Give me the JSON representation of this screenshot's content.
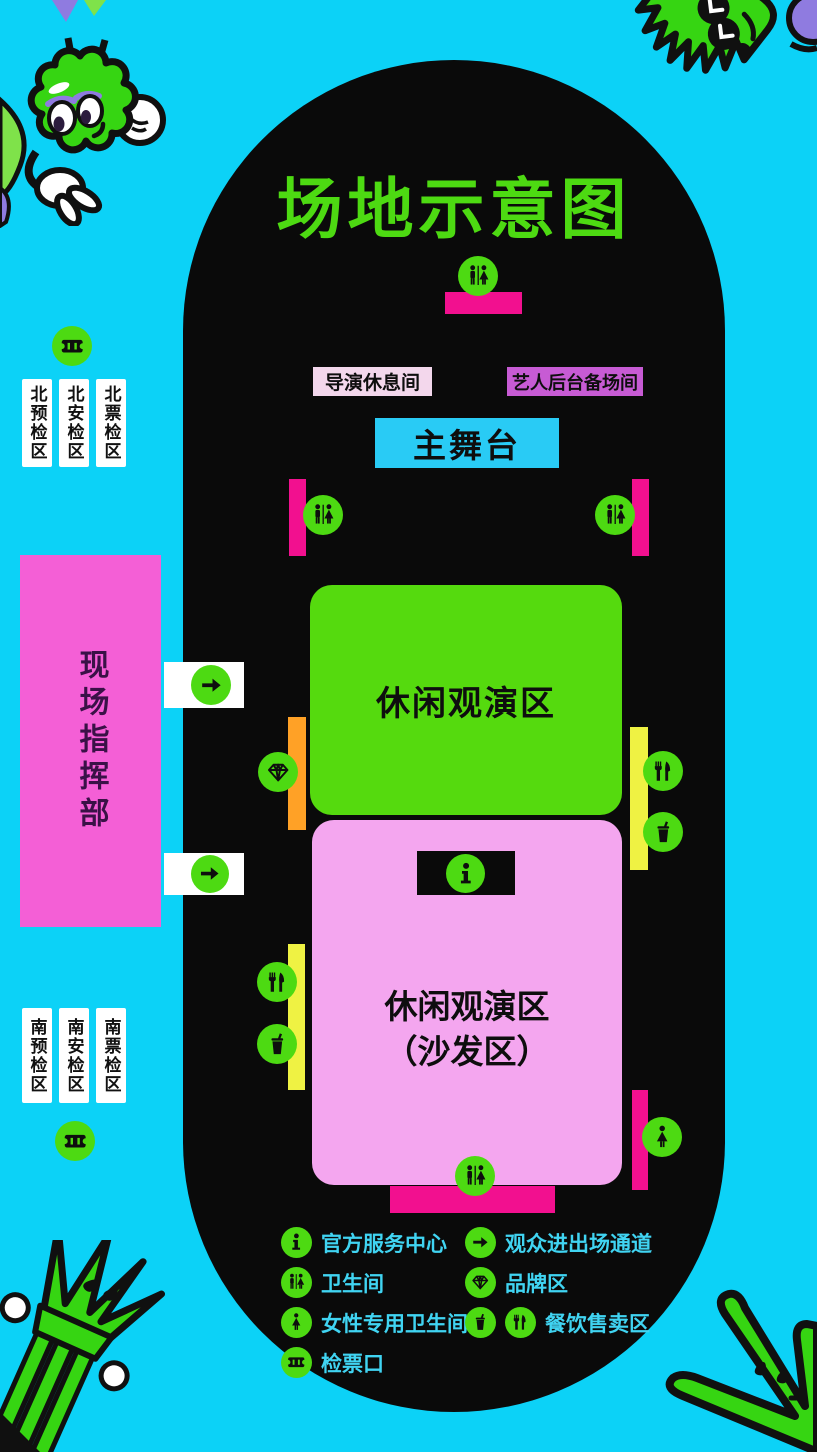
{
  "title": "场地示意图",
  "stage_area": {
    "director_lounge": "导演休息间",
    "artist_backstage": "艺人后台备场间",
    "main_stage": "主舞台"
  },
  "zones": {
    "leisure_viewing": "休闲观演区",
    "sofa_line1": "休闲观演区",
    "sofa_line2": "（沙发区）",
    "command_center": "现场指挥部"
  },
  "checkpoints": {
    "north": [
      "北预检区",
      "北安检区",
      "北票检区"
    ],
    "south": [
      "南预检区",
      "南安检区",
      "南票检区"
    ]
  },
  "legend": {
    "left": [
      {
        "icon": "info-icon",
        "label": "官方服务中心"
      },
      {
        "icon": "restroom-icon",
        "label": "卫生间"
      },
      {
        "icon": "female-restroom-icon",
        "label": "女性专用卫生间"
      },
      {
        "icon": "ticket-icon",
        "label": "检票口"
      }
    ],
    "right": [
      {
        "icon": "arrow-icon",
        "label": "观众进出场通道"
      },
      {
        "icon": "diamond-icon",
        "label": "品牌区"
      },
      {
        "icon": "cup-icon,fork-knife-icon",
        "label": "餐饮售卖区"
      }
    ]
  },
  "colors": {
    "background": "#0CD2F7",
    "field_black": "#0A0A0A",
    "green": "#4DDA12",
    "magenta": "#F2108F",
    "command_pink": "#F45FD6",
    "sofa_pink": "#F4A6EF",
    "director_label_pink": "#F3D7EC",
    "artist_label_purple": "#C75BD4",
    "stage_cyan": "#29CBF5",
    "orange": "#FFA126",
    "yellow": "#EFF243",
    "legend_text_cyan": "#40D4F2"
  }
}
